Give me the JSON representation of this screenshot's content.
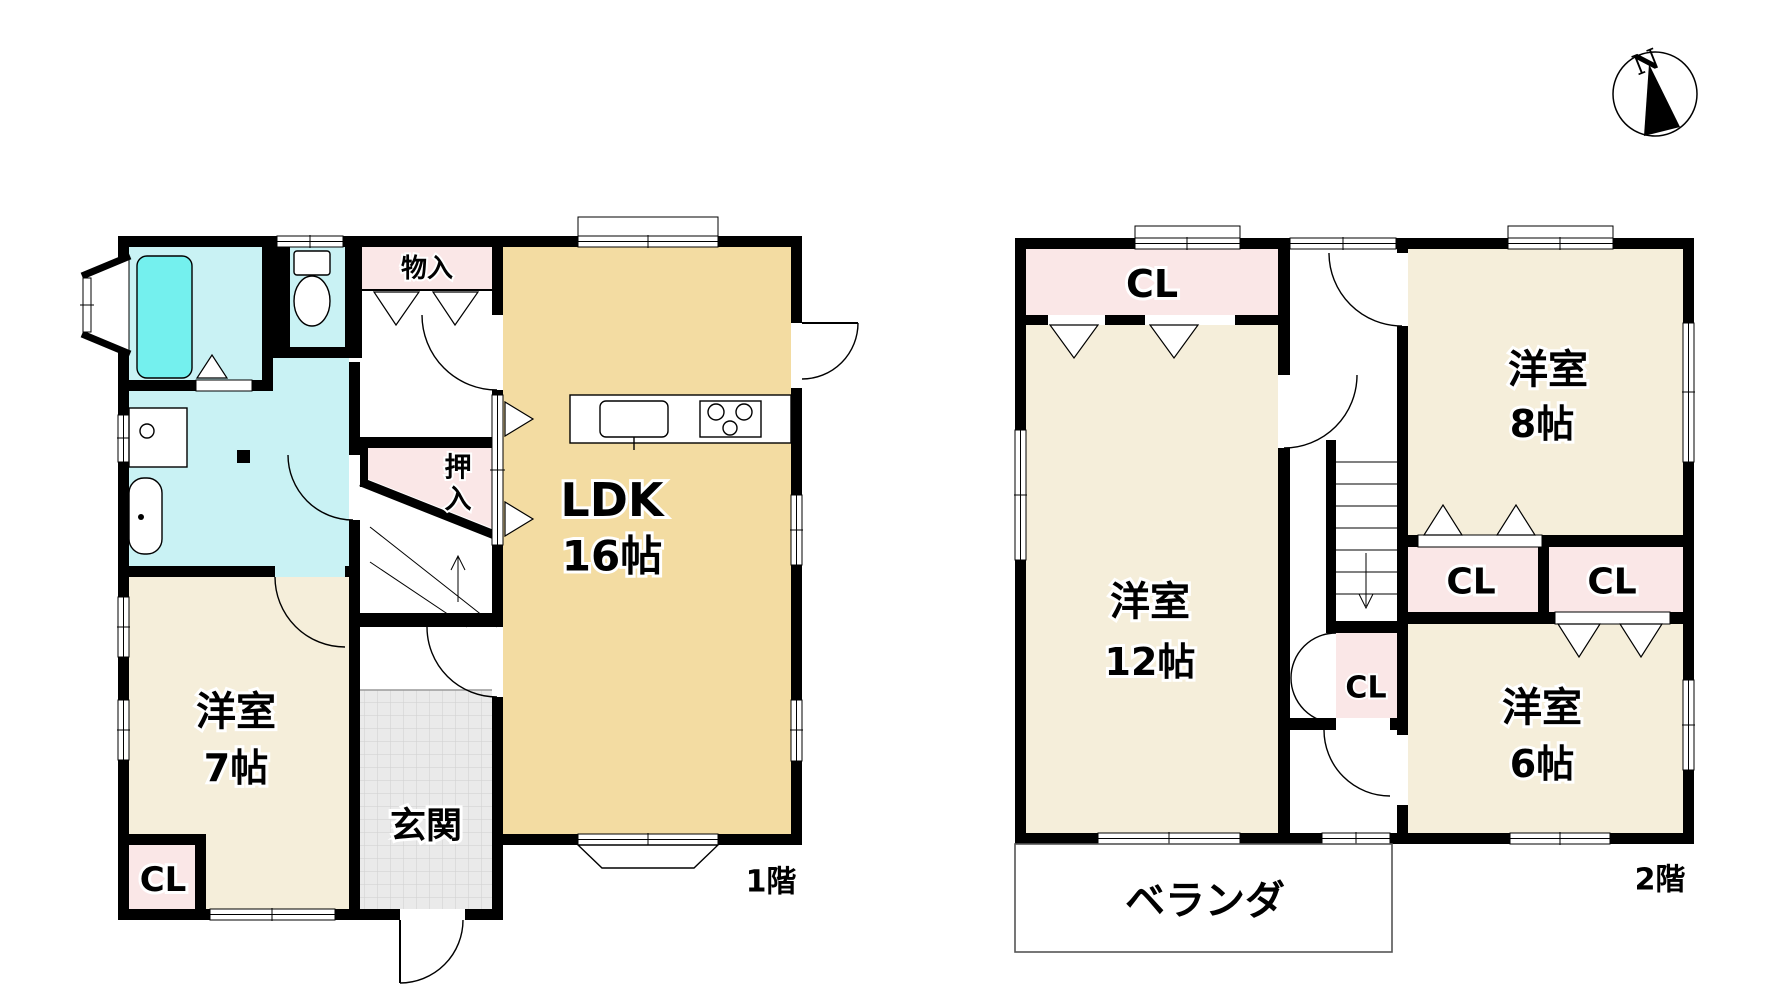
{
  "compass": {
    "north_label": "N"
  },
  "floor1": {
    "floor_label": "1階",
    "labels": {
      "storage_top": "物入",
      "oshiire_char1": "押",
      "oshiire_char2": "入",
      "ldk_name": "LDK",
      "ldk_size": "16帖",
      "west_room_name": "洋室",
      "west_room_size": "7帖",
      "entrance": "玄関",
      "closet": "CL"
    }
  },
  "floor2": {
    "floor_label": "2階",
    "labels": {
      "closet_nw": "CL",
      "room12_name": "洋室",
      "room12_size": "12帖",
      "room8_name": "洋室",
      "room8_size": "8帖",
      "closet_stair": "CL",
      "closet_mid_left": "CL",
      "closet_mid_right": "CL",
      "room6_name": "洋室",
      "room6_size": "6帖",
      "veranda": "ベランダ"
    }
  },
  "colors": {
    "wall": "#000000",
    "room_cream": "#F5EEDA",
    "ldk_tan": "#F3DCA2",
    "closet_pink": "#FAE7E7",
    "bath_cyan": "#C9F2F4",
    "tub_cyan": "#74F0EE",
    "entrance_gray": "#EAEAEA"
  }
}
